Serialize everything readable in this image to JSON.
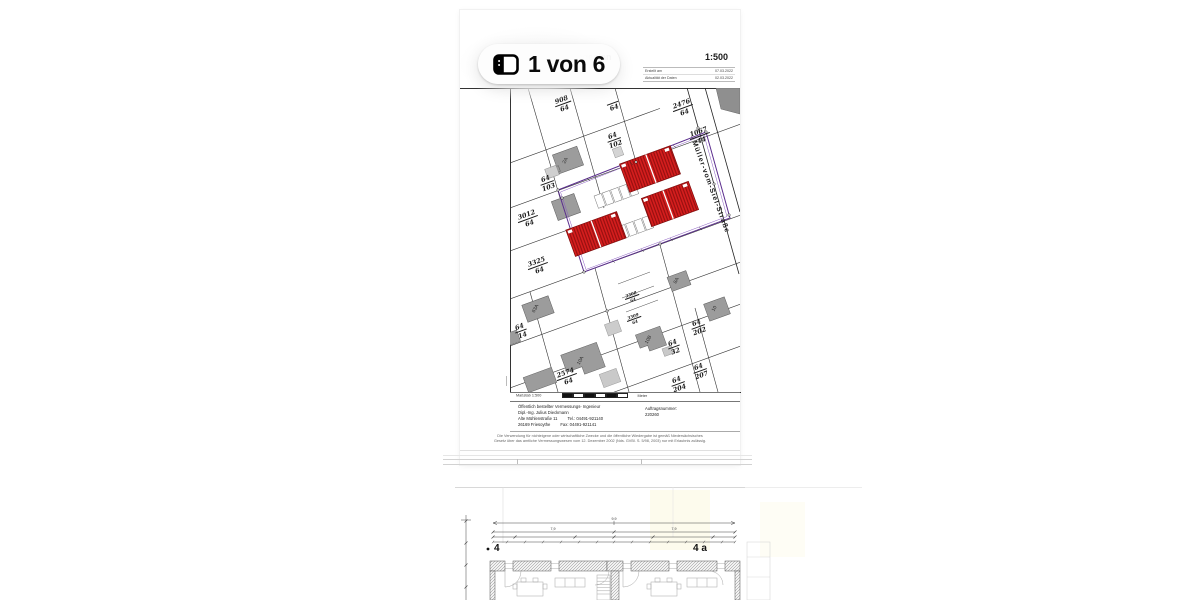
{
  "viewer": {
    "page_badge_label": "1 von 6"
  },
  "page1": {
    "header": {
      "title": "Lageplan",
      "subtitle": "Gemk. I. Flurst.",
      "doc_number": "220766",
      "scale": "1:500",
      "meta": [
        {
          "label": "Erstellt am",
          "value": "07.03.2022"
        },
        {
          "label": "Aktualität der Daten",
          "value": "02.03.2022"
        }
      ]
    },
    "plan": {
      "street_name": "Müller-vom-Siel-Straße",
      "parcels": [
        {
          "num": "908",
          "den": "64"
        },
        {
          "den": "64"
        },
        {
          "num": "2476",
          "den": "64"
        },
        {
          "num": "1067",
          "den": "44"
        },
        {
          "num": "64",
          "den": "102"
        },
        {
          "num": "64",
          "den": "103"
        },
        {
          "num": "3012",
          "den": "64"
        },
        {
          "num": "3325",
          "den": "64"
        },
        {
          "num": "64",
          "den": "14"
        },
        {
          "num": "2574",
          "den": "64"
        },
        {
          "num": "3308",
          "den": "64"
        },
        {
          "num": "3309",
          "den": "64"
        },
        {
          "num": "64",
          "den": "202"
        },
        {
          "num": "64",
          "den": "32"
        },
        {
          "num": "64",
          "den": "207"
        },
        {
          "num": "64",
          "den": "204"
        }
      ],
      "house_labels": [
        "2A",
        "63A",
        "10A",
        "10B",
        "8A",
        "10"
      ]
    },
    "footer": {
      "scale_label": "Maßstab",
      "scale_value": "1:500",
      "unit": "Meter",
      "surveyor_line1": "Öffentlich bestellter Vermessungs- Ingenieur",
      "surveyor_line2": "Dipl.-Ing. Julius Dieckmann",
      "address1": "Alte Mühlenstraße 11",
      "phone": "Tel.: 04491-921140",
      "address2": "26169 Friesoythe",
      "fax": "Fax: 04491-921141",
      "order_label": "Auftragsnummer:",
      "order_number": "220260",
      "disclaimer1": "Die Verwendung für nichteigene oder wirtschaftliche Zwecke und die öffentliche Wiedergabe ist gemäß Niedersächsisches",
      "disclaimer2": "Gesetz über das amtliche Vermessungswesen vom 12. Dezember 2002 (Nds. GVBl. S. 5/98, 2003) nur mit Erlaubnis zulässig."
    }
  },
  "page2": {
    "label_left": "4",
    "label_right": "4 a",
    "dims": {
      "total": "9,9",
      "left": "7,9",
      "right": "7,9"
    }
  },
  "colors": {
    "new_building_red": "#d61e1e",
    "existing_gray": "#9c9c9c",
    "boundary_purple": "#5b2d8e"
  }
}
